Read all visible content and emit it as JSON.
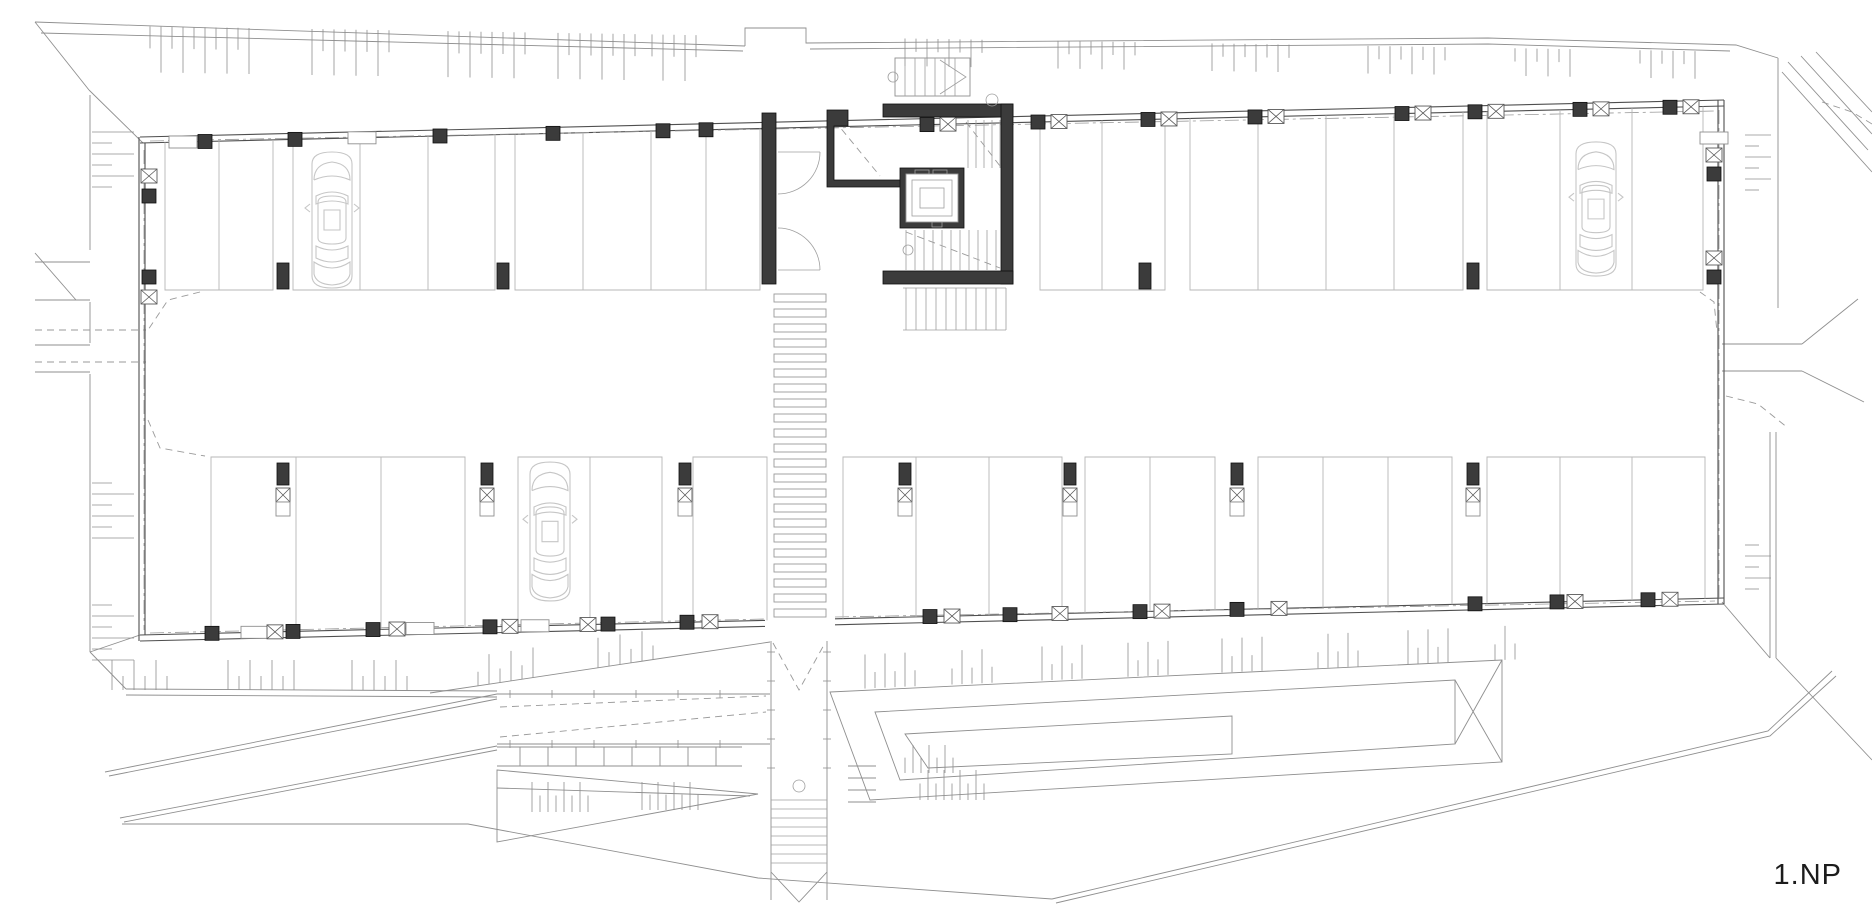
{
  "page": {
    "title": "1.NP",
    "background": "#ffffff"
  },
  "plan": {
    "floor_label": "1.NP",
    "kind": "architectural-floor-plan",
    "subject": "parking-garage-level-1",
    "colors": {
      "wall": "#4f4f4f",
      "site": "#8f8f8f",
      "parking": "#b7b7b7",
      "car": "#c6c6c6",
      "concrete": "#3b3b3b",
      "label": "#1c1c1c"
    },
    "building": {
      "top": [
        140,
        143,
        1724,
        106
      ],
      "bottom": [
        140,
        635,
        1724,
        598
      ],
      "left_x": 140,
      "right_x": 1724,
      "band_top_bottom": 290,
      "band_bottom_top": 457
    },
    "top_groups": [
      {
        "x1": 165,
        "x2": 273,
        "div": [
          219
        ]
      },
      {
        "x1": 293,
        "x2": 495,
        "div": [
          360,
          428
        ]
      },
      {
        "x1": 515,
        "x2": 760,
        "div": [
          583,
          651,
          706
        ]
      },
      {
        "x1": 1040,
        "x2": 1165,
        "div": [
          1102
        ]
      },
      {
        "x1": 1190,
        "x2": 1463,
        "div": [
          1258,
          1326,
          1394
        ]
      },
      {
        "x1": 1487,
        "x2": 1703,
        "div": [
          1560,
          1632
        ]
      }
    ],
    "bottom_groups": [
      {
        "x1": 211,
        "x2": 465,
        "div": [
          296,
          381
        ]
      },
      {
        "x1": 518,
        "x2": 662,
        "div": [
          590
        ]
      },
      {
        "x1": 693,
        "x2": 767,
        "div": []
      },
      {
        "x1": 843,
        "x2": 1062,
        "div": [
          916,
          989
        ]
      },
      {
        "x1": 1085,
        "x2": 1215,
        "div": [
          1150
        ]
      },
      {
        "x1": 1258,
        "x2": 1452,
        "div": [
          1323,
          1388
        ]
      },
      {
        "x1": 1487,
        "x2": 1705,
        "div": [
          1560,
          1632
        ]
      }
    ],
    "cars": [
      {
        "x": 304,
        "y": 150,
        "h": 140
      },
      {
        "x": 1568,
        "y": 140,
        "h": 138
      },
      {
        "x": 522,
        "y": 460,
        "h": 143
      }
    ],
    "top_wall_marks": [
      {
        "x": 183,
        "k": "wr"
      },
      {
        "x": 205,
        "k": "col"
      },
      {
        "x": 295,
        "k": "col"
      },
      {
        "x": 362,
        "k": "wr"
      },
      {
        "x": 440,
        "k": "col"
      },
      {
        "x": 553,
        "k": "col"
      },
      {
        "x": 663,
        "k": "col"
      },
      {
        "x": 706,
        "k": "col"
      },
      {
        "x": 927,
        "k": "col"
      },
      {
        "x": 948,
        "k": "xb"
      },
      {
        "x": 1038,
        "k": "col"
      },
      {
        "x": 1059,
        "k": "xb"
      },
      {
        "x": 1148,
        "k": "col"
      },
      {
        "x": 1169,
        "k": "xb"
      },
      {
        "x": 1255,
        "k": "col"
      },
      {
        "x": 1276,
        "k": "xb"
      },
      {
        "x": 1402,
        "k": "col"
      },
      {
        "x": 1423,
        "k": "xb"
      },
      {
        "x": 1475,
        "k": "col"
      },
      {
        "x": 1496,
        "k": "xb"
      },
      {
        "x": 1580,
        "k": "col"
      },
      {
        "x": 1601,
        "k": "xb"
      },
      {
        "x": 1670,
        "k": "col"
      },
      {
        "x": 1691,
        "k": "xb"
      }
    ],
    "bottom_wall_marks": [
      {
        "x": 212,
        "k": "col"
      },
      {
        "x": 255,
        "k": "wr"
      },
      {
        "x": 275,
        "k": "xb"
      },
      {
        "x": 293,
        "k": "col"
      },
      {
        "x": 373,
        "k": "col"
      },
      {
        "x": 397,
        "k": "xb"
      },
      {
        "x": 420,
        "k": "wr"
      },
      {
        "x": 490,
        "k": "col"
      },
      {
        "x": 510,
        "k": "xb"
      },
      {
        "x": 535,
        "k": "wr"
      },
      {
        "x": 588,
        "k": "xb"
      },
      {
        "x": 608,
        "k": "col"
      },
      {
        "x": 687,
        "k": "col"
      },
      {
        "x": 710,
        "k": "xb"
      },
      {
        "x": 930,
        "k": "col"
      },
      {
        "x": 952,
        "k": "xb"
      },
      {
        "x": 1010,
        "k": "col"
      },
      {
        "x": 1060,
        "k": "xb"
      },
      {
        "x": 1140,
        "k": "col"
      },
      {
        "x": 1162,
        "k": "xb"
      },
      {
        "x": 1237,
        "k": "col"
      },
      {
        "x": 1279,
        "k": "xb"
      },
      {
        "x": 1475,
        "k": "col"
      },
      {
        "x": 1557,
        "k": "col"
      },
      {
        "x": 1575,
        "k": "xb"
      },
      {
        "x": 1648,
        "k": "col"
      },
      {
        "x": 1670,
        "k": "xb"
      }
    ],
    "left_wall_marks": [
      {
        "y": 176,
        "k": "xb"
      },
      {
        "y": 196,
        "k": "col"
      },
      {
        "y": 277,
        "k": "col"
      },
      {
        "y": 297,
        "k": "xb"
      }
    ],
    "right_wall_marks": [
      {
        "y": 138,
        "k": "wr"
      },
      {
        "y": 155,
        "k": "xb"
      },
      {
        "y": 174,
        "k": "col"
      },
      {
        "y": 258,
        "k": "xb"
      },
      {
        "y": 277,
        "k": "col"
      }
    ],
    "row_a_cols": [
      283,
      503,
      1145,
      1473
    ],
    "row_b_cols": [
      283,
      487,
      685,
      905,
      1070,
      1237,
      1473
    ],
    "zebra": {
      "x": 774,
      "w": 52,
      "y0": 294,
      "bar_h": 8,
      "step": 15,
      "count": 22
    },
    "corridor": {
      "x1": 771,
      "x2": 827,
      "y1": 641,
      "y2": 900,
      "tread_y0": 800,
      "treads": 8,
      "circle_y": 786
    },
    "top_hatch_clusters": [
      [
        150,
        255
      ],
      [
        312,
        392
      ],
      [
        448,
        528
      ],
      [
        558,
        640
      ],
      [
        652,
        700
      ],
      [
        905,
        988
      ],
      [
        1058,
        1140
      ],
      [
        1212,
        1295
      ],
      [
        1368,
        1448
      ],
      [
        1515,
        1578
      ],
      [
        1640,
        1698
      ]
    ],
    "bottom_hatch_left": [
      [
        112,
        172
      ],
      [
        228,
        296
      ],
      [
        352,
        416
      ]
    ],
    "bottom_hatch_wedge": [
      [
        478,
        540
      ],
      [
        598,
        658
      ]
    ],
    "bottom_hatch_right": [
      [
        865,
        915
      ],
      [
        952,
        1000
      ],
      [
        1042,
        1090
      ],
      [
        1128,
        1176
      ],
      [
        1222,
        1268
      ],
      [
        1318,
        1362
      ],
      [
        1408,
        1452
      ],
      [
        1495,
        1518
      ]
    ],
    "left_ticks": [
      [
        132,
        190
      ],
      [
        483,
        545
      ],
      [
        605,
        662
      ]
    ],
    "right_ticks": [
      [
        135,
        190
      ],
      [
        545,
        598
      ]
    ],
    "site_lines": [
      [
        [
          35,
          22
        ],
        [
          745,
          46
        ]
      ],
      [
        [
          41,
          33
        ],
        [
          743,
          51
        ]
      ],
      [
        [
          745,
          46
        ],
        [
          745,
          28
        ],
        [
          806,
          28
        ],
        [
          806,
          43
        ],
        [
          1488,
          38
        ],
        [
          1736,
          45
        ],
        [
          1778,
          58
        ]
      ],
      [
        [
          810,
          49
        ],
        [
          1488,
          44
        ],
        [
          1730,
          51
        ]
      ],
      [
        [
          35,
          22
        ],
        [
          89,
          90
        ]
      ],
      [
        [
          90,
          95
        ],
        [
          90,
          250
        ]
      ],
      [
        [
          90,
          302
        ],
        [
          90,
          343
        ]
      ],
      [
        [
          90,
          374
        ],
        [
          90,
          652
        ]
      ],
      [
        [
          90,
          652
        ],
        [
          126,
          689
        ]
      ],
      [
        [
          35,
          262
        ],
        [
          90,
          262
        ]
      ],
      [
        [
          35,
          300
        ],
        [
          90,
          300
        ]
      ],
      [
        [
          35,
          253
        ],
        [
          76,
          300
        ]
      ],
      [
        [
          35,
          345
        ],
        [
          90,
          345
        ]
      ],
      [
        [
          35,
          372
        ],
        [
          90,
          372
        ]
      ],
      [
        [
          1778,
          58
        ],
        [
          1778,
          308
        ]
      ],
      [
        [
          1722,
          344
        ],
        [
          1802,
          344
        ]
      ],
      [
        [
          1722,
          371
        ],
        [
          1802,
          371
        ]
      ],
      [
        [
          1802,
          344
        ],
        [
          1858,
          299
        ]
      ],
      [
        [
          1802,
          371
        ],
        [
          1864,
          402
        ]
      ],
      [
        [
          1788,
          62
        ],
        [
          1868,
          150
        ]
      ],
      [
        [
          1801,
          56
        ],
        [
          1872,
          134
        ]
      ],
      [
        [
          1816,
          52
        ],
        [
          1872,
          112
        ]
      ],
      [
        [
          1782,
          72
        ],
        [
          1872,
          172
        ]
      ],
      [
        [
          1770,
          432
        ],
        [
          1770,
          658
        ]
      ],
      [
        [
          1776,
          432
        ],
        [
          1776,
          658
        ]
      ],
      [
        [
          1722,
          602
        ],
        [
          1770,
          658
        ]
      ],
      [
        [
          1776,
          658
        ],
        [
          1872,
          760
        ]
      ],
      [
        [
          126,
          689
        ],
        [
          497,
          691
        ]
      ],
      [
        [
          126,
          695
        ],
        [
          497,
          697
        ]
      ],
      [
        [
          105,
          772
        ],
        [
          497,
          694
        ]
      ],
      [
        [
          109,
          776
        ],
        [
          497,
          699
        ]
      ],
      [
        [
          120,
          818
        ],
        [
          497,
          746
        ]
      ],
      [
        [
          124,
          822
        ],
        [
          497,
          750
        ]
      ],
      [
        [
          122,
          824
        ],
        [
          468,
          824
        ],
        [
          758,
          878
        ],
        [
          1052,
          899
        ]
      ],
      [
        [
          1052,
          899
        ],
        [
          1768,
          731
        ],
        [
          1832,
          671
        ]
      ],
      [
        [
          1056,
          903
        ],
        [
          1770,
          736
        ],
        [
          1836,
          676
        ]
      ],
      [
        [
          430,
          693
        ],
        [
          770,
          642
        ]
      ],
      [
        [
          89,
          90
        ],
        [
          143,
          143
        ]
      ],
      [
        [
          90,
          652
        ],
        [
          140,
          635
        ]
      ]
    ],
    "dashed_lines": [
      [
        [
          200,
          292
        ],
        [
          168,
          300
        ],
        [
          148,
          330
        ]
      ],
      [
        [
          35,
          330
        ],
        [
          146,
          330
        ]
      ],
      [
        [
          35,
          362
        ],
        [
          146,
          362
        ]
      ],
      [
        [
          148,
          420
        ],
        [
          160,
          448
        ],
        [
          205,
          456
        ]
      ],
      [
        [
          1700,
          292
        ],
        [
          1714,
          302
        ],
        [
          1717,
          332
        ]
      ],
      [
        [
          1726,
          396
        ],
        [
          1758,
          404
        ],
        [
          1788,
          428
        ]
      ],
      [
        [
          1822,
          102
        ],
        [
          1852,
          112
        ],
        [
          1872,
          124
        ]
      ],
      [
        [
          773,
          643
        ],
        [
          799,
          690
        ],
        [
          825,
          643
        ]
      ],
      [
        [
          834,
          120
        ],
        [
          880,
          176
        ]
      ],
      [
        [
          966,
          122
        ],
        [
          1000,
          166
        ]
      ],
      [
        [
          906,
          232
        ],
        [
          1000,
          268
        ]
      ]
    ],
    "dashdot_lines": [
      [
        [
          150,
          141
        ],
        [
          1715,
          111
        ]
      ],
      [
        [
          150,
          633
        ],
        [
          765,
          619
        ]
      ],
      [
        [
          835,
          617
        ],
        [
          1715,
          601
        ]
      ],
      [
        [
          144,
          150
        ],
        [
          144,
          630
        ]
      ],
      [
        [
          1719,
          110
        ],
        [
          1719,
          598
        ]
      ]
    ],
    "ramp_quads": [
      [
        [
          830,
          692
        ],
        [
          1502,
          660
        ],
        [
          1502,
          762
        ],
        [
          870,
          800
        ]
      ],
      [
        [
          875,
          712
        ],
        [
          1455,
          680
        ],
        [
          1455,
          744
        ],
        [
          900,
          780
        ]
      ],
      [
        [
          905,
          734
        ],
        [
          1232,
          716
        ],
        [
          1232,
          754
        ],
        [
          928,
          768
        ]
      ]
    ],
    "ramp_folds": [
      [
        [
          1455,
          680
        ],
        [
          1502,
          762
        ]
      ],
      [
        [
          1455,
          744
        ],
        [
          1502,
          660
        ]
      ]
    ],
    "ramp_steps": [
      766,
      778,
      790,
      802
    ],
    "ramp_strip1": {
      "x1": 497,
      "x2": 770,
      "ytop": 694,
      "ybot": 744,
      "dash": [
        [
          [
            500,
            707
          ],
          [
            766,
            696
          ]
        ],
        [
          [
            500,
            737
          ],
          [
            766,
            712
          ]
        ]
      ]
    },
    "ramp_strip2": {
      "x1": 497,
      "x2": 742,
      "ytop": 747,
      "ybot": 766,
      "vstep": 28
    },
    "funnel": {
      "poly": [
        [
          497,
          770
        ],
        [
          758,
          794
        ],
        [
          497,
          842
        ]
      ],
      "inner": [
        [
          497,
          788
        ],
        [
          750,
          796
        ]
      ]
    },
    "funnel_ticks": [
      {
        "x0": 532,
        "x1": 588,
        "yb": 812,
        "len": 30
      },
      {
        "x0": 642,
        "x1": 698,
        "yb": 810,
        "len": 28
      }
    ],
    "quad_ticks": [
      {
        "x0": 905,
        "x1": 955,
        "yb": 773,
        "len": 28
      },
      {
        "x0": 920,
        "x1": 990,
        "yb": 800,
        "len": 30
      }
    ],
    "core": {
      "w1": [
        762,
        113,
        14,
        171
      ],
      "w2_path": "M827,110 L848,110 L848,126 L834,126 L834,180 L906,180 L906,187 L827,187 Z",
      "w3": [
        883,
        104,
        130,
        13
      ],
      "w4": [
        1001,
        104,
        12,
        180
      ],
      "w5": [
        883,
        271,
        130,
        13
      ],
      "elevator": {
        "outer": [
          900,
          168,
          64,
          60
        ],
        "inner": [
          906,
          174,
          52,
          48
        ],
        "car": [
          912,
          180,
          40,
          36
        ],
        "cab": [
          920,
          188,
          24,
          20
        ]
      },
      "stair_upper": {
        "x0": 968,
        "x1": 1000,
        "step": 8,
        "y1": 120,
        "y2": 168
      },
      "stair_lower": {
        "x0": 906,
        "x1": 1000,
        "step": 9,
        "y1": 230,
        "y2": 270,
        "circle": [
          908,
          250
        ]
      },
      "stair_below": {
        "x0": 906,
        "x1": 1006,
        "step": 10,
        "y1": 288,
        "y2": 330
      },
      "doors": [
        {
          "px": 778,
          "py": 152,
          "lx": 820,
          "sweep": 1
        },
        {
          "px": 778,
          "py": 270,
          "lx": 820,
          "sweep": 0
        }
      ],
      "ext_stair": {
        "rect": [
          895,
          58,
          75,
          38
        ],
        "tread_x0": 905,
        "tread_x1": 955,
        "step": 10,
        "chevron": [
          [
            940,
            60
          ],
          [
            966,
            77
          ],
          [
            940,
            94
          ]
        ],
        "circle": [
          893,
          77
        ]
      },
      "axis_circle": [
        992,
        100
      ]
    }
  }
}
